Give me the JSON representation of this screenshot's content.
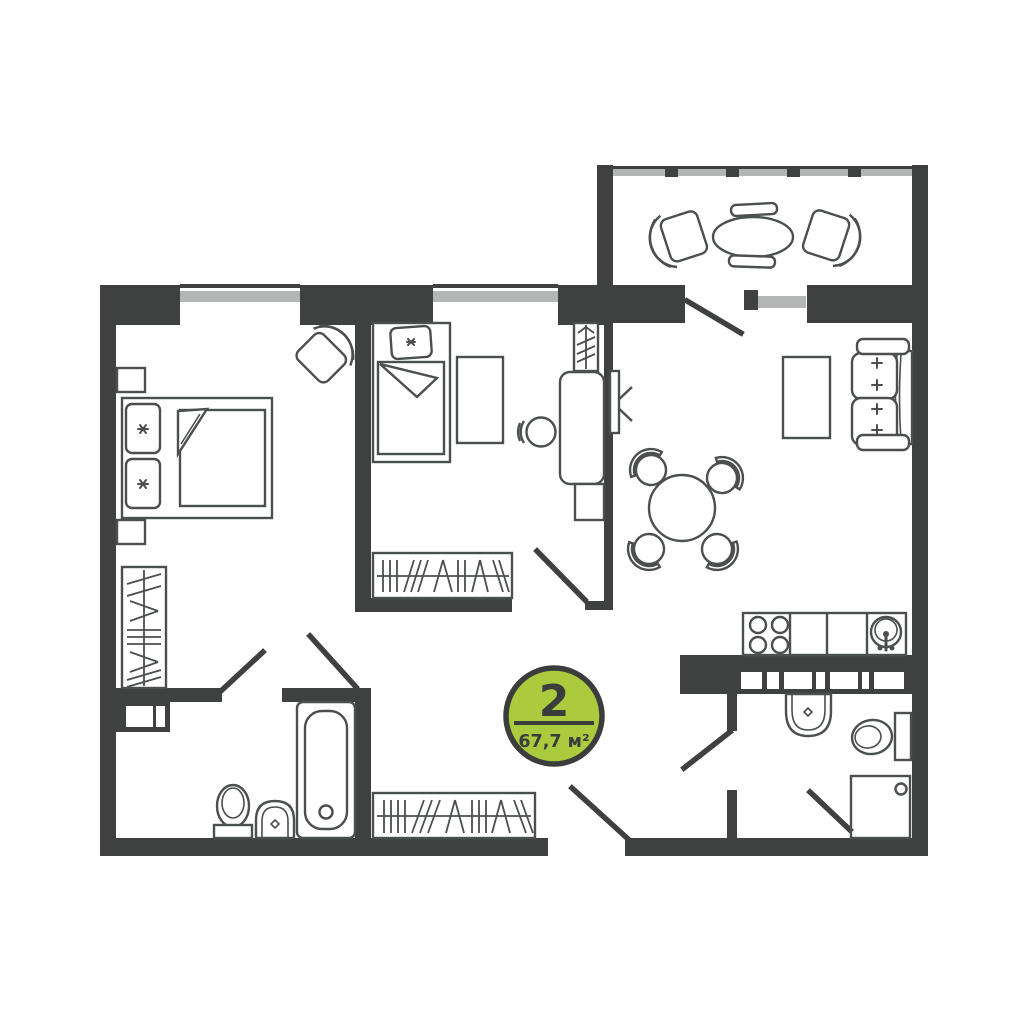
{
  "badge": {
    "rooms_count": "2",
    "area": "67,7 м²"
  },
  "colors": {
    "wall": "#3E4140",
    "furniture": "#4B4F4E",
    "window": "#B3B6B5",
    "badge_fill": "#A9CB3D",
    "badge_stroke": "#3A3D3C",
    "background": "#FFFFFF"
  }
}
